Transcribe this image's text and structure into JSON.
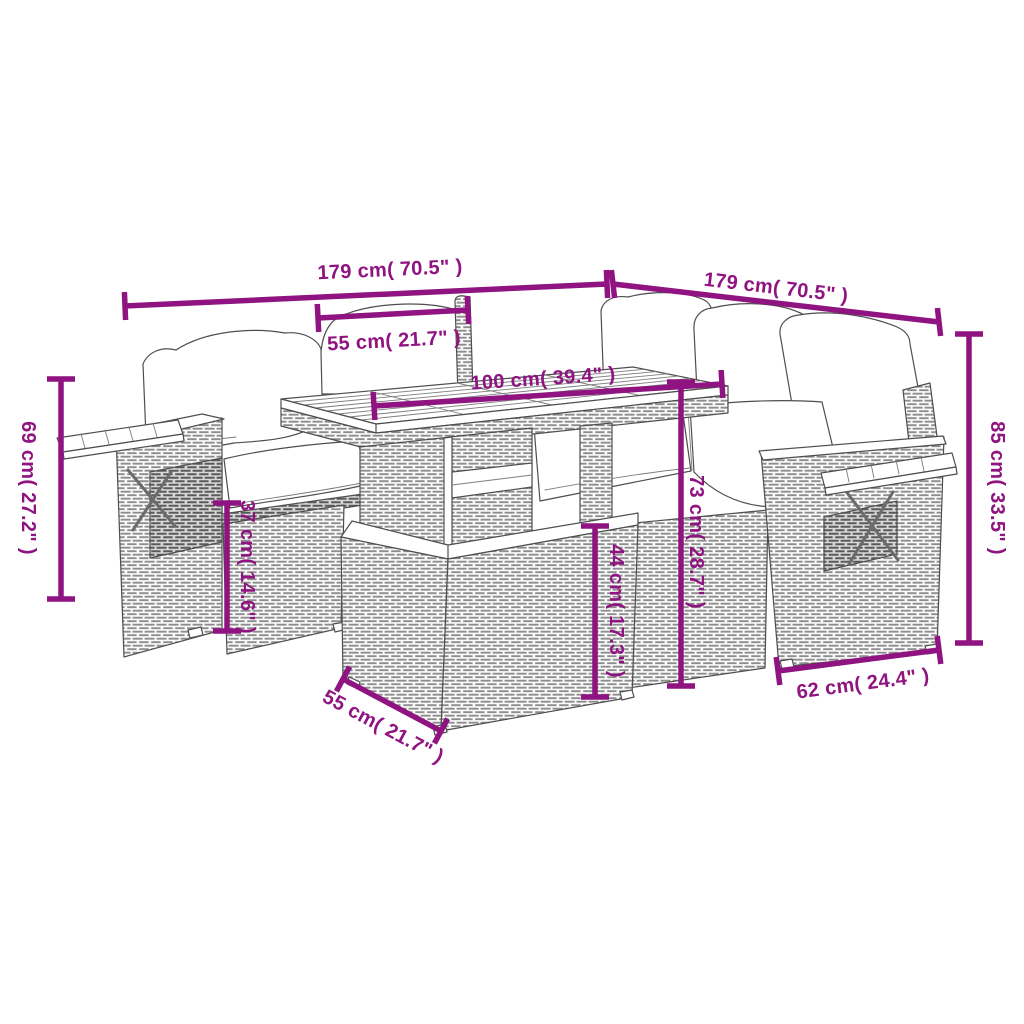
{
  "diagram": {
    "type": "product-dimension-line-drawing",
    "subject": "garden rattan lounge set with table and ottoman",
    "background_color": "#FFFFFF",
    "accent_color": "#8F1380",
    "line_art_color": "#4E4E4E",
    "annotations": [
      {
        "id": "sofa-left-width",
        "label": "179 cm( 70.5\" )"
      },
      {
        "id": "sofa-right-width",
        "label": "179 cm( 70.5\" )"
      },
      {
        "id": "seat-width",
        "label": "55 cm( 21.7\" )"
      },
      {
        "id": "tabletop-length",
        "label": "100 cm( 39.4\" )"
      },
      {
        "id": "backrest-height",
        "label": "69 cm( 27.2\" )"
      },
      {
        "id": "seat-height",
        "label": "37 cm( 14.6\" )"
      },
      {
        "id": "ottoman-height",
        "label": "44 cm( 17.3\" )"
      },
      {
        "id": "table-height",
        "label": "73 cm( 28.7\" )"
      },
      {
        "id": "total-height",
        "label": "85 cm( 33.5\" )"
      },
      {
        "id": "armrest-depth",
        "label": "62 cm( 24.4\" )"
      },
      {
        "id": "ottoman-width",
        "label": "55 cm( 21.7\" )"
      }
    ]
  }
}
